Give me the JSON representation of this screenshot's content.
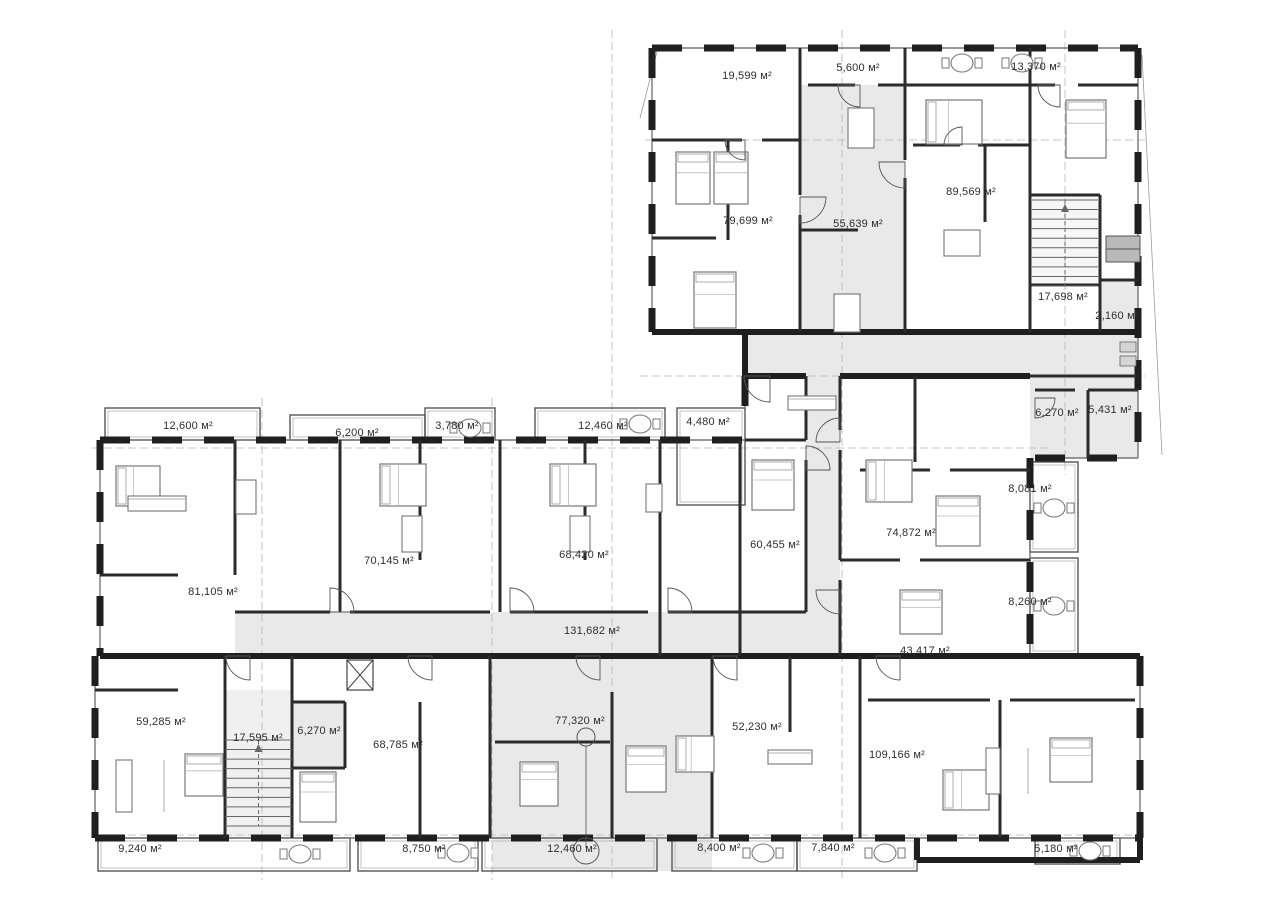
{
  "plan": {
    "title": "Apartment building floor plan",
    "unit": "м²",
    "areas": [
      {
        "name": "terrace-19599",
        "kind": "terrace",
        "label": "19,599 м²",
        "x": 747,
        "y": 79
      },
      {
        "name": "terrace-5600",
        "kind": "terrace",
        "label": "5,600 м²",
        "x": 858,
        "y": 71
      },
      {
        "name": "terrace-13370",
        "kind": "terrace",
        "label": "13,370 м²",
        "x": 1036,
        "y": 70
      },
      {
        "name": "apartment-79699",
        "kind": "apartment",
        "label": "79,699 м²",
        "x": 748,
        "y": 224
      },
      {
        "name": "apartment-55639",
        "kind": "apartment",
        "label": "55,639 м²",
        "x": 858,
        "y": 227
      },
      {
        "name": "apartment-89569",
        "kind": "apartment",
        "label": "89,569 м²",
        "x": 971,
        "y": 195
      },
      {
        "name": "stair-17698",
        "kind": "stairwell",
        "label": "17,698 м²",
        "x": 1063,
        "y": 300
      },
      {
        "name": "room-2160",
        "kind": "room",
        "label": "2,160 м²",
        "x": 1117,
        "y": 319
      },
      {
        "name": "room-6270-top",
        "kind": "room",
        "label": "6,270 м²",
        "x": 1057,
        "y": 416
      },
      {
        "name": "room-5431",
        "kind": "room",
        "label": "5,431 м²",
        "x": 1110,
        "y": 413
      },
      {
        "name": "balcony-12600",
        "kind": "balcony",
        "label": "12,600 м²",
        "x": 188,
        "y": 429
      },
      {
        "name": "balcony-6200",
        "kind": "balcony",
        "label": "6,200 м²",
        "x": 357,
        "y": 436
      },
      {
        "name": "balcony-3780",
        "kind": "balcony",
        "label": "3,780 м²",
        "x": 457,
        "y": 429
      },
      {
        "name": "balcony-12460-top",
        "kind": "balcony",
        "label": "12,460 м²",
        "x": 603,
        "y": 429
      },
      {
        "name": "balcony-4480",
        "kind": "balcony",
        "label": "4,480 м²",
        "x": 708,
        "y": 425
      },
      {
        "name": "apartment-81105",
        "kind": "apartment",
        "label": "81,105 м²",
        "x": 213,
        "y": 595
      },
      {
        "name": "apartment-70145",
        "kind": "apartment",
        "label": "70,145 м²",
        "x": 389,
        "y": 564
      },
      {
        "name": "apartment-68420",
        "kind": "apartment",
        "label": "68,420 м²",
        "x": 584,
        "y": 558
      },
      {
        "name": "apartment-60455",
        "kind": "apartment",
        "label": "60,455 м²",
        "x": 775,
        "y": 548
      },
      {
        "name": "apartment-74872",
        "kind": "apartment",
        "label": "74,872 м²",
        "x": 911,
        "y": 536
      },
      {
        "name": "balcony-8081",
        "kind": "balcony",
        "label": "8,081 м²",
        "x": 1030,
        "y": 492
      },
      {
        "name": "corridor-131682",
        "kind": "corridor",
        "label": "131,682 м²",
        "x": 592,
        "y": 634
      },
      {
        "name": "apartment-43417",
        "kind": "apartment",
        "label": "43,417 м²",
        "x": 925,
        "y": 654
      },
      {
        "name": "balcony-8260",
        "kind": "balcony",
        "label": "8,260 м²",
        "x": 1030,
        "y": 605
      },
      {
        "name": "apartment-59285",
        "kind": "apartment",
        "label": "59,285 м²",
        "x": 161,
        "y": 725
      },
      {
        "name": "stair-17595",
        "kind": "stairwell",
        "label": "17,595 м²",
        "x": 258,
        "y": 741
      },
      {
        "name": "room-6270-bottom",
        "kind": "room",
        "label": "6,270 м²",
        "x": 319,
        "y": 734
      },
      {
        "name": "apartment-68785",
        "kind": "apartment",
        "label": "68,785 м²",
        "x": 398,
        "y": 748
      },
      {
        "name": "apartment-77320",
        "kind": "apartment",
        "label": "77,320 м²",
        "x": 580,
        "y": 724
      },
      {
        "name": "apartment-52230",
        "kind": "apartment",
        "label": "52,230 м²",
        "x": 757,
        "y": 730
      },
      {
        "name": "apartment-109166",
        "kind": "apartment",
        "label": "109,166 м²",
        "x": 897,
        "y": 758
      },
      {
        "name": "balcony-9240",
        "kind": "balcony",
        "label": "9,240 м²",
        "x": 140,
        "y": 852
      },
      {
        "name": "balcony-8750",
        "kind": "balcony",
        "label": "8,750 м²",
        "x": 424,
        "y": 852
      },
      {
        "name": "balcony-12460-bottom",
        "kind": "balcony",
        "label": "12,460 м²",
        "x": 572,
        "y": 852
      },
      {
        "name": "balcony-8400",
        "kind": "balcony",
        "label": "8,400 м²",
        "x": 719,
        "y": 851
      },
      {
        "name": "balcony-7840",
        "kind": "balcony",
        "label": "7,840 м²",
        "x": 833,
        "y": 851
      },
      {
        "name": "balcony-5180",
        "kind": "balcony",
        "label": "5,180 м²",
        "x": 1056,
        "y": 852
      }
    ],
    "colors": {
      "wall": "#1f1f1f",
      "interior_wall": "#2b2b2b",
      "corridor_fill": "#e9e9e9",
      "stair_fill": "#f0f0f0",
      "equipment_fill": "#b9b9b9",
      "reference_line": "#b5b5b5",
      "label_text": "#2e2e2e"
    }
  }
}
